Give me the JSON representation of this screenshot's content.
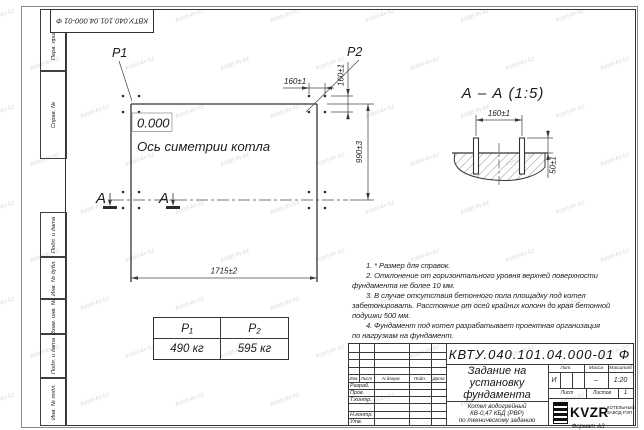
{
  "corner_stamp": "КВТУ.040.101.04.000-01 Ф",
  "watermark": {
    "text": "kotel-kv.kz"
  },
  "margin_labels": {
    "perv_primen": "Перв. примен.",
    "sprav_no": "Справ. №",
    "podp_data_1": "Подп. и дата",
    "inv_dubl": "Инв. № дубл.",
    "vzam_inv": "Взам. инв. №",
    "podp_data_2": "Подп. и дата",
    "inv_podl": "Инв. № подл."
  },
  "plan": {
    "p1": "P1",
    "p2": "P2",
    "level": "0.000",
    "axis_label": "Ось симетрии котла",
    "section_letter": "А",
    "dim_width_top": "160±1",
    "dim_height_side": "160±1",
    "dim_990": "990±3",
    "dim_1715": "1715±2"
  },
  "section_view": {
    "title": "А – А (1:5)",
    "dim_160": "160±1",
    "dim_50": "50±1"
  },
  "load_table": {
    "col1_header": "P₁",
    "col2_header": "P₂",
    "col1_value": "490 кг",
    "col2_value": "595 кг"
  },
  "notes": {
    "lines": [
      "1. * Размер для справок.",
      "2. Отклонение от горизонтального уровня верхней поверхности",
      "фундамента не более 10 мм.",
      "3. В случае отсутствия бетонного пола площадку под котел",
      "забетонировать. Расстояние от осей крайних колонн до края бетонной",
      "подушки 500 мм.",
      "4. Фундамент под котел разрабатывает проектная организация",
      "по нагрузкам на фундамент."
    ]
  },
  "title_block": {
    "doc_number": "КВТУ.040.101.04.000-01 Ф",
    "cols": [
      "Изм.",
      "Лист",
      "N докум.",
      "Подп.",
      "Дата"
    ],
    "rows": [
      "Разраб.",
      "Пров.",
      "Т.контр.",
      "Н.контр.",
      "Утв."
    ],
    "title_lines": [
      "Задание на",
      "установку",
      "фундамента"
    ],
    "subtitle_lines": [
      "Котел водогрейный",
      "КВ-0,47 КБД (РВР)",
      "по техническому заданию"
    ],
    "lit_label": "Лит.",
    "mass_label": "Масса",
    "scale_label": "Масштаб",
    "lit_value": "И",
    "mass_value": "–",
    "scale_value": "1:20",
    "sheet_label": "Лист",
    "sheets_label": "Листов",
    "sheets_value": "1",
    "logo_text": "KVZR",
    "logo_sub_lines": [
      "КОТЕЛЬНЫЙ",
      "ЗАВОД РЭП"
    ],
    "format_label": "Формат А3"
  }
}
